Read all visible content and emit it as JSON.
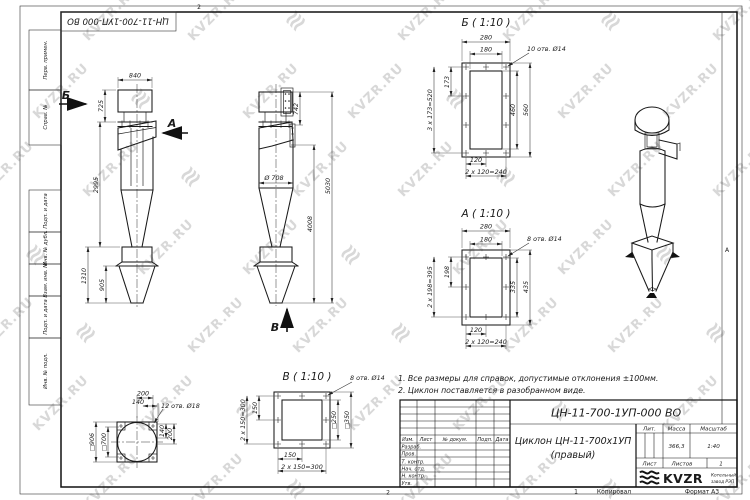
{
  "watermark": {
    "text": "KVZR.RU",
    "glyph": "≋"
  },
  "frame": {
    "top_stamp": "ЦН-11-700-1УП-000 ВО",
    "zone_top": "2",
    "zone_bottom": "2",
    "copy_number": "1",
    "kopiroval": "Копировал",
    "format": "Формат А3",
    "zone_letter": "А",
    "left_labels": [
      "Перв. примен.",
      "Справ. №",
      "Подп. и дата",
      "Инв. № дубл.",
      "Взам. инв. №",
      "Подп. и дата",
      "Инв. № подл."
    ]
  },
  "notes": {
    "line1": "1. Все размеры для справок, допустимые отклонения ±100мм.",
    "line2": "2. Циклон поставляется в разобранном виде."
  },
  "front_view": {
    "label_b": "Б",
    "label_a": "А",
    "dim_840": "840",
    "dim_725": "725",
    "dim_2995": "2995",
    "dim_1310": "1310",
    "dim_905": "905"
  },
  "side_view": {
    "label_v": "В",
    "dim_742": "742",
    "dim_d708": "Ø 708",
    "dim_5030": "5030",
    "dim_4008": "4008"
  },
  "view_b": {
    "title": "Б ( 1:10 )",
    "holes": "10 отв. Ø14",
    "dim_280": "280",
    "dim_180": "180",
    "dim_173": "173",
    "dim_3x173": "3 х 173=520",
    "dim_460": "460",
    "dim_560": "560",
    "dim_120": "120",
    "dim_2x120": "2 х 120=240"
  },
  "view_a": {
    "title": "А ( 1:10 )",
    "holes": "8 отв. Ø14",
    "dim_280": "280",
    "dim_180": "180",
    "dim_198": "198",
    "dim_2x198": "2 х 198=395",
    "dim_335": "335",
    "dim_435": "435",
    "dim_120": "120",
    "dim_2x120": "2 х 120=240"
  },
  "view_v": {
    "title": "В ( 1:10 )",
    "holes": "8 отв. Ø14",
    "dim_150_l": "150",
    "dim_2x150_l": "2 х 150=300",
    "dim_250": "□250",
    "dim_350": "□350",
    "dim_150_b": "150",
    "dim_2x150_b": "2 х 150=300"
  },
  "flange_view": {
    "holes": "12 отв. Ø18",
    "dim_200_t": "200",
    "dim_140_t": "140",
    "dim_906": "□906",
    "dim_700": "□700",
    "dim_140_r": "140",
    "dim_200_r": "200"
  },
  "title_block": {
    "designation": "ЦН-11-700-1УП-000 ВО",
    "name_line1": "Циклон ЦН-11-700х1УП",
    "name_line2": "(правый)",
    "col_izm": "Изм.",
    "col_list": "Лист",
    "col_doc": "№ докум.",
    "col_podp": "Подп.",
    "col_data": "Дата",
    "row_razrab": "Разраб.",
    "row_prov": "Пров.",
    "row_tkontr": "Т. контр.",
    "row_nachotd": "Нач. отд.",
    "row_nkontr": "Н. контр.",
    "row_utv": "Утв.",
    "lit_label": "Лит.",
    "massa_label": "Масса",
    "masshtab_label": "Масштаб",
    "massa_value": "366,3",
    "masshtab_value": "1:40",
    "list_label": "Лист",
    "listov_label": "Листов",
    "listov_value": "1",
    "logo_text": "KVZR",
    "logo_sub1": "Котельный",
    "logo_sub2": "завод РЭП"
  }
}
